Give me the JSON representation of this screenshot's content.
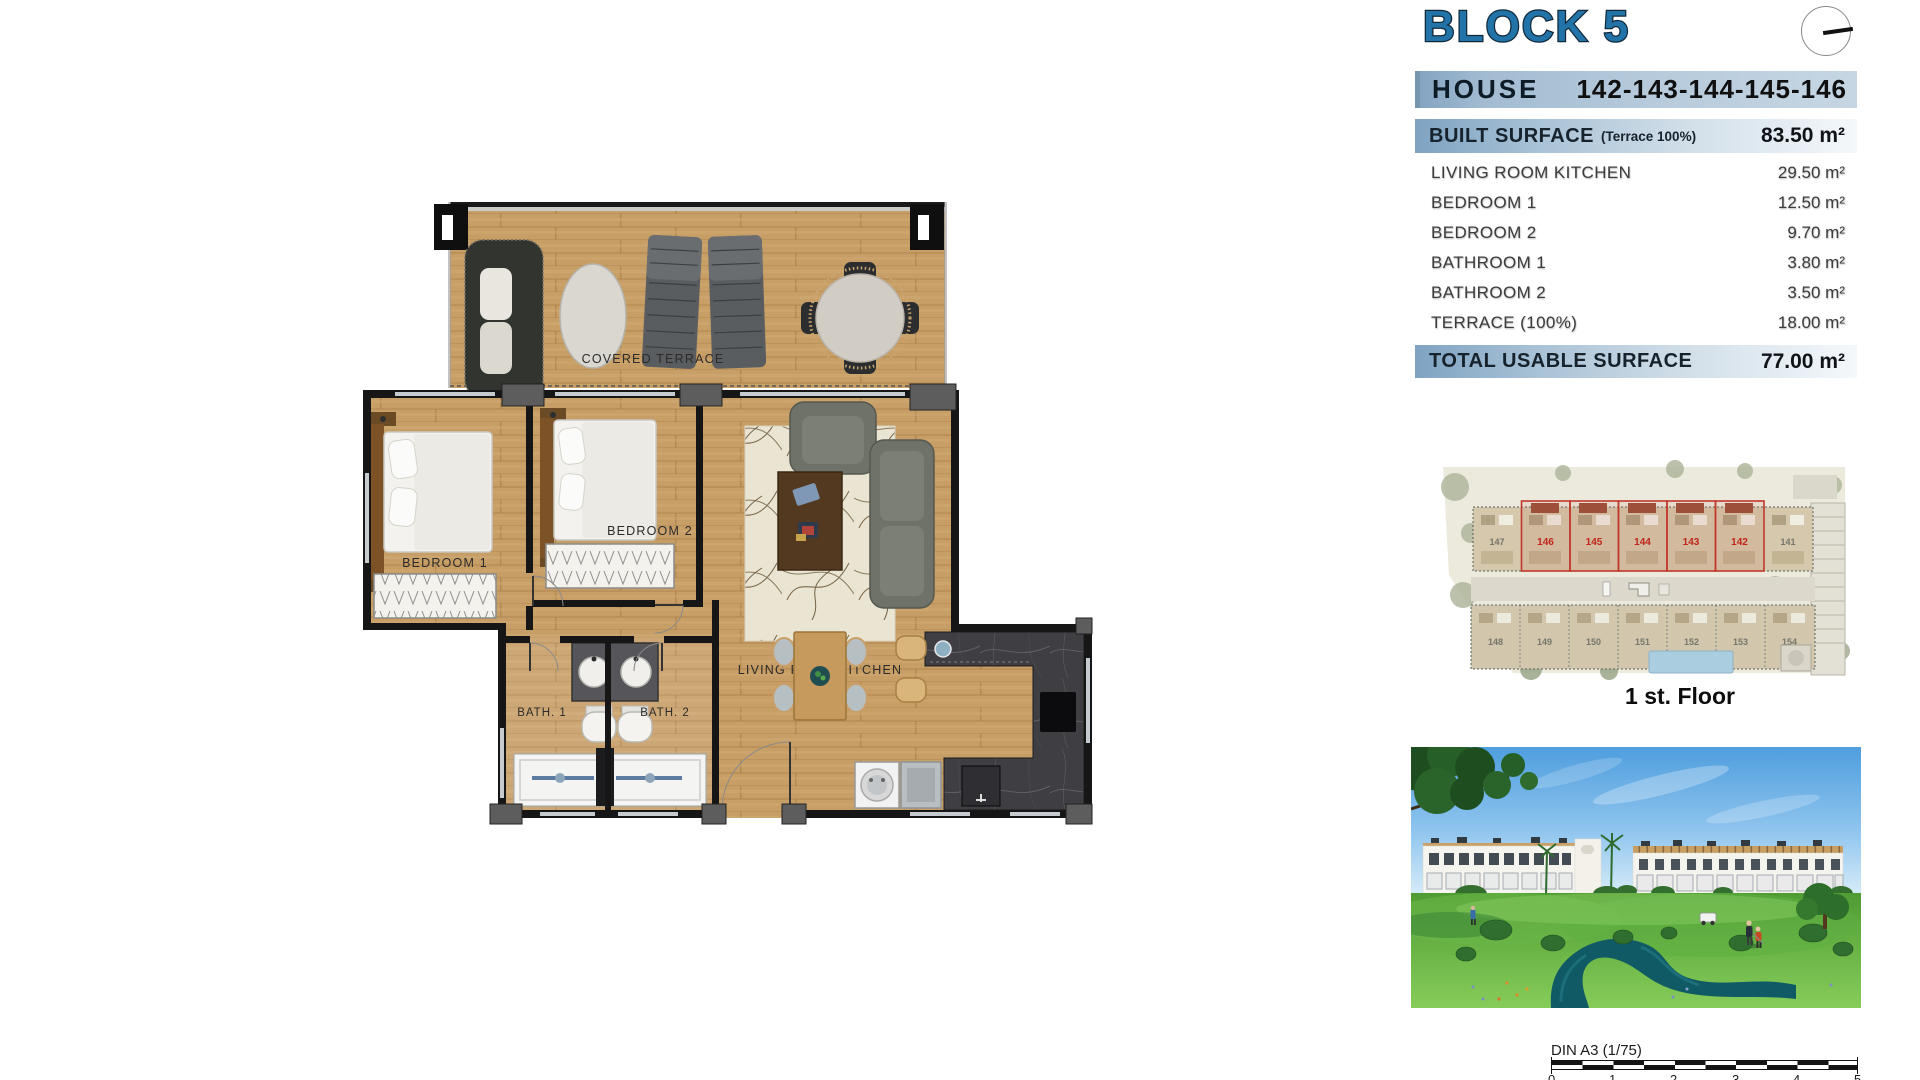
{
  "header": {
    "title": "BLOCK 5",
    "house_label": "HOUSE",
    "house_numbers": "142-143-144-145-146"
  },
  "surface_table": {
    "built_label": "BUILT SURFACE",
    "built_note": "(Terrace 100%)",
    "built_value": "83.50 m²",
    "rows": [
      {
        "label": "LIVING ROOM KITCHEN",
        "value": "29.50 m²"
      },
      {
        "label": "BEDROOM 1",
        "value": "12.50 m²"
      },
      {
        "label": "BEDROOM 2",
        "value": "9.70 m²"
      },
      {
        "label": "BATHROOM 1",
        "value": "3.80 m²"
      },
      {
        "label": "BATHROOM 2",
        "value": "3.50 m²"
      },
      {
        "label": "TERRACE (100%)",
        "value": "18.00 m²"
      }
    ],
    "total_label": "TOTAL USABLE SURFACE",
    "total_value": "77.00 m²"
  },
  "floor_plan": {
    "terrace": "COVERED TERRACE",
    "bedroom1": "BEDROOM 1",
    "bedroom2": "BEDROOM 2",
    "living": "LIVING ROOM KITCHEN",
    "bath1": "BATH. 1",
    "bath2": "BATH. 2"
  },
  "site_plan": {
    "caption": "1 st. Floor",
    "left_unit": "147",
    "right_unit": "141",
    "highlight_units": [
      "146",
      "145",
      "144",
      "143",
      "142"
    ],
    "bottom_units": [
      "148",
      "149",
      "150",
      "151",
      "152",
      "153",
      "154"
    ],
    "highlight_color": "#c0392b"
  },
  "footer": {
    "scale_label": "DIN A3 (1/75)",
    "ticks": [
      "0",
      "1",
      "2",
      "3",
      "4",
      "5"
    ]
  },
  "colors": {
    "accent_blue": "#2273a8",
    "bar_blue": "#8fafca",
    "wood": "#c79e66",
    "marble": "#3e3e43"
  }
}
